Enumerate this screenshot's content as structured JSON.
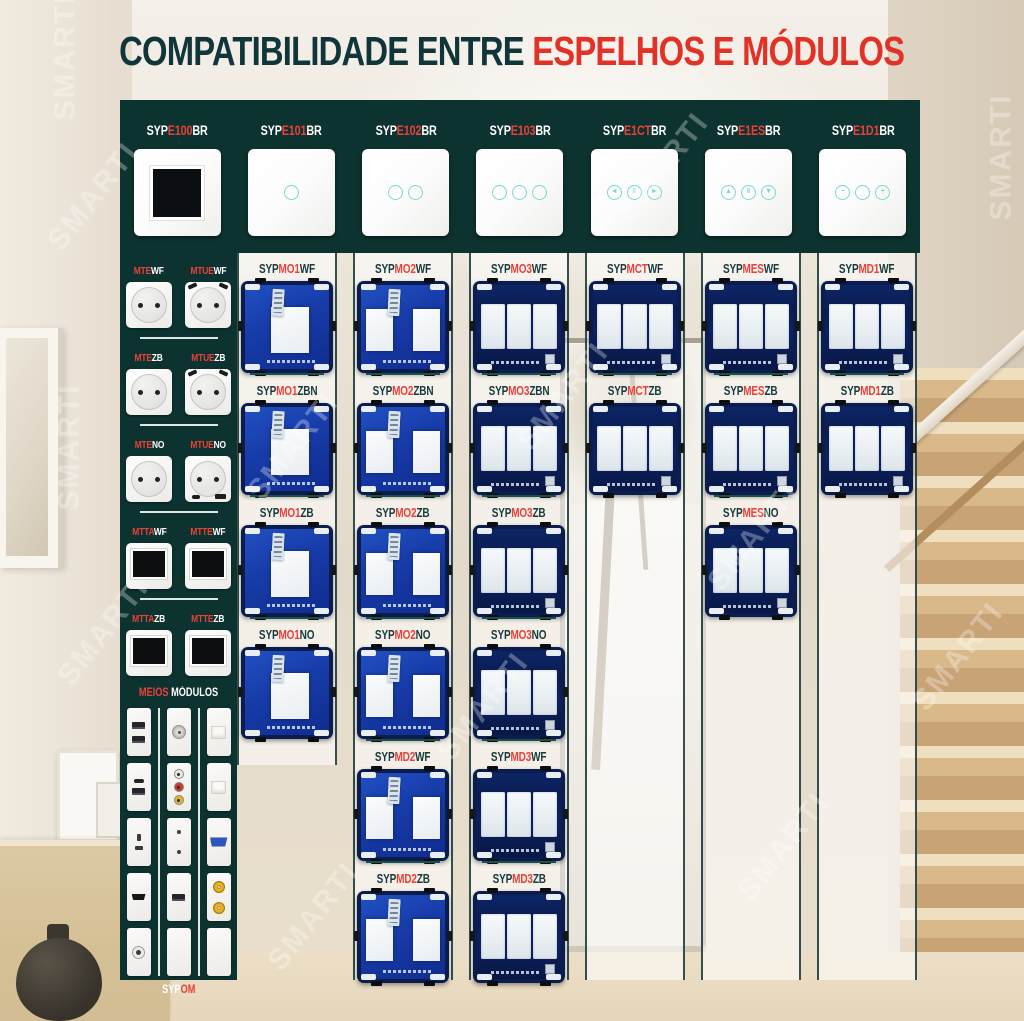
{
  "title": {
    "dark": "COMPATIBILIDADE ENTRE",
    "red": "ESPELHOS E MÓDULOS"
  },
  "watermark": "SMARTI",
  "colors": {
    "accent_red": "#e23227",
    "panel_teal": "#0d3330",
    "touch_ring": "#7ad8d1",
    "pcb_blue": "#1740ad"
  },
  "espelhos": [
    {
      "label": [
        [
          "SYP",
          "w"
        ],
        [
          "E100",
          "r"
        ],
        [
          "BR",
          "w"
        ]
      ],
      "icon": "blank-frame"
    },
    {
      "label": [
        [
          "SYP",
          "w"
        ],
        [
          "E101",
          "r"
        ],
        [
          "BR",
          "w"
        ]
      ],
      "icon": "touch-1"
    },
    {
      "label": [
        [
          "SYP",
          "w"
        ],
        [
          "E102",
          "r"
        ],
        [
          "BR",
          "w"
        ]
      ],
      "icon": "touch-2"
    },
    {
      "label": [
        [
          "SYP",
          "w"
        ],
        [
          "E103",
          "r"
        ],
        [
          "BR",
          "w"
        ]
      ],
      "icon": "touch-3"
    },
    {
      "label": [
        [
          "SYP",
          "w"
        ],
        [
          "E1CT",
          "r"
        ],
        [
          "BR",
          "w"
        ]
      ],
      "icon": "curtain",
      "glyphs": [
        "◄",
        "‖",
        "►"
      ]
    },
    {
      "label": [
        [
          "SYP",
          "w"
        ],
        [
          "E1ES",
          "r"
        ],
        [
          "BR",
          "w"
        ]
      ],
      "icon": "shutter",
      "glyphs": [
        "▲",
        "‖",
        "▼"
      ]
    },
    {
      "label": [
        [
          "SYP",
          "w"
        ],
        [
          "E1D1",
          "r"
        ],
        [
          "BR",
          "w"
        ]
      ],
      "icon": "dimmer",
      "glyphs": [
        "−",
        "",
        "+"
      ]
    }
  ],
  "sidebar": {
    "rows": [
      {
        "items": [
          {
            "label": [
              [
                "MTE",
                "r"
              ],
              [
                "WF",
                "w"
              ]
            ],
            "type": "socket"
          },
          {
            "label": [
              [
                "MTUE",
                "r"
              ],
              [
                "WF",
                "w"
              ]
            ],
            "type": "socket-usb-top"
          }
        ]
      },
      {
        "items": [
          {
            "label": [
              [
                "MTE",
                "r"
              ],
              [
                "ZB",
                "w"
              ]
            ],
            "type": "socket"
          },
          {
            "label": [
              [
                "MTUE",
                "r"
              ],
              [
                "ZB",
                "w"
              ]
            ],
            "type": "socket-usb-top"
          }
        ]
      },
      {
        "items": [
          {
            "label": [
              [
                "MTE",
                "r"
              ],
              [
                "NO",
                "w"
              ]
            ],
            "type": "socket"
          },
          {
            "label": [
              [
                "MTUE",
                "r"
              ],
              [
                "NO",
                "w"
              ]
            ],
            "type": "socket-usb-bottom"
          }
        ]
      },
      {
        "items": [
          {
            "label": [
              [
                "MTTA",
                "r"
              ],
              [
                "WF",
                "w"
              ]
            ],
            "type": "thermostat"
          },
          {
            "label": [
              [
                "MTTE",
                "r"
              ],
              [
                "WF",
                "w"
              ]
            ],
            "type": "thermostat"
          }
        ]
      },
      {
        "items": [
          {
            "label": [
              [
                "MTTA",
                "r"
              ],
              [
                "ZB",
                "w"
              ]
            ],
            "type": "thermostat"
          },
          {
            "label": [
              [
                "MTTE",
                "r"
              ],
              [
                "ZB",
                "w"
              ]
            ],
            "type": "thermostat"
          }
        ]
      }
    ],
    "meios_title": [
      [
        "MEIOS",
        "r"
      ],
      [
        " MÓDULOS",
        "w"
      ]
    ],
    "meios_columns": [
      [
        "usb-double",
        "usbc-usba",
        "socket-2pin",
        "hdmi",
        "audio-jack"
      ],
      [
        "tv-coax",
        "rca-triple",
        "dots-2",
        "usb-single",
        "blank"
      ],
      [
        "rj45",
        "rj45",
        "vga",
        "sat-double",
        "blank"
      ]
    ],
    "bottom_label": [
      [
        "SYP",
        "w"
      ],
      [
        "OM",
        "r"
      ]
    ]
  },
  "columns": [
    {
      "modules": [
        {
          "label": [
            [
              "SYP",
              "d"
            ],
            [
              "MO1",
              "r"
            ],
            [
              "WF",
              "d"
            ]
          ],
          "variant": "m1"
        },
        {
          "label": [
            [
              "SYP",
              "d"
            ],
            [
              "MO1",
              "r"
            ],
            [
              "ZBN",
              "d"
            ]
          ],
          "variant": "m1"
        },
        {
          "label": [
            [
              "SYP",
              "d"
            ],
            [
              "MO1",
              "r"
            ],
            [
              "ZB",
              "d"
            ]
          ],
          "variant": "m1"
        },
        {
          "label": [
            [
              "SYP",
              "d"
            ],
            [
              "MO1",
              "r"
            ],
            [
              "NO",
              "d"
            ]
          ],
          "variant": "m1"
        }
      ]
    },
    {
      "modules": [
        {
          "label": [
            [
              "SYP",
              "d"
            ],
            [
              "MO2",
              "r"
            ],
            [
              "WF",
              "d"
            ]
          ],
          "variant": "m2"
        },
        {
          "label": [
            [
              "SYP",
              "d"
            ],
            [
              "MO2",
              "r"
            ],
            [
              "ZBN",
              "d"
            ]
          ],
          "variant": "m2"
        },
        {
          "label": [
            [
              "SYP",
              "d"
            ],
            [
              "MO2",
              "r"
            ],
            [
              "ZB",
              "d"
            ]
          ],
          "variant": "m2"
        },
        {
          "label": [
            [
              "SYP",
              "d"
            ],
            [
              "MO2",
              "r"
            ],
            [
              "NO",
              "d"
            ]
          ],
          "variant": "m2"
        },
        {
          "label": [
            [
              "SYP",
              "d"
            ],
            [
              "MD2",
              "r"
            ],
            [
              "WF",
              "d"
            ]
          ],
          "variant": "m2"
        },
        {
          "label": [
            [
              "SYP",
              "d"
            ],
            [
              "MD2",
              "r"
            ],
            [
              "ZB",
              "d"
            ]
          ],
          "variant": "m2"
        }
      ]
    },
    {
      "modules": [
        {
          "label": [
            [
              "SYP",
              "d"
            ],
            [
              "MO3",
              "r"
            ],
            [
              "WF",
              "d"
            ]
          ],
          "variant": "m3"
        },
        {
          "label": [
            [
              "SYP",
              "d"
            ],
            [
              "MO3",
              "r"
            ],
            [
              "ZBN",
              "d"
            ]
          ],
          "variant": "m3"
        },
        {
          "label": [
            [
              "SYP",
              "d"
            ],
            [
              "MO3",
              "r"
            ],
            [
              "ZB",
              "d"
            ]
          ],
          "variant": "m3"
        },
        {
          "label": [
            [
              "SYP",
              "d"
            ],
            [
              "MO3",
              "r"
            ],
            [
              "NO",
              "d"
            ]
          ],
          "variant": "m3"
        },
        {
          "label": [
            [
              "SYP",
              "d"
            ],
            [
              "MD3",
              "r"
            ],
            [
              "WF",
              "d"
            ]
          ],
          "variant": "m3"
        },
        {
          "label": [
            [
              "SYP",
              "d"
            ],
            [
              "MD3",
              "r"
            ],
            [
              "ZB",
              "d"
            ]
          ],
          "variant": "m3"
        }
      ]
    },
    {
      "modules": [
        {
          "label": [
            [
              "SYP",
              "d"
            ],
            [
              "MCT",
              "r"
            ],
            [
              "WF",
              "d"
            ]
          ],
          "variant": "m3"
        },
        {
          "label": [
            [
              "SYP",
              "d"
            ],
            [
              "MCT",
              "r"
            ],
            [
              "ZB",
              "d"
            ]
          ],
          "variant": "m3"
        }
      ]
    },
    {
      "modules": [
        {
          "label": [
            [
              "SYP",
              "d"
            ],
            [
              "MES",
              "r"
            ],
            [
              "WF",
              "d"
            ]
          ],
          "variant": "m3"
        },
        {
          "label": [
            [
              "SYP",
              "d"
            ],
            [
              "MES",
              "r"
            ],
            [
              "ZB",
              "d"
            ]
          ],
          "variant": "m3"
        },
        {
          "label": [
            [
              "SYP",
              "d"
            ],
            [
              "MES",
              "r"
            ],
            [
              "NO",
              "d"
            ]
          ],
          "variant": "m3"
        }
      ]
    },
    {
      "modules": [
        {
          "label": [
            [
              "SYP",
              "d"
            ],
            [
              "MD1",
              "r"
            ],
            [
              "WF",
              "d"
            ]
          ],
          "variant": "m3"
        },
        {
          "label": [
            [
              "SYP",
              "d"
            ],
            [
              "MD1",
              "r"
            ],
            [
              "ZB",
              "d"
            ]
          ],
          "variant": "m3"
        }
      ]
    }
  ]
}
